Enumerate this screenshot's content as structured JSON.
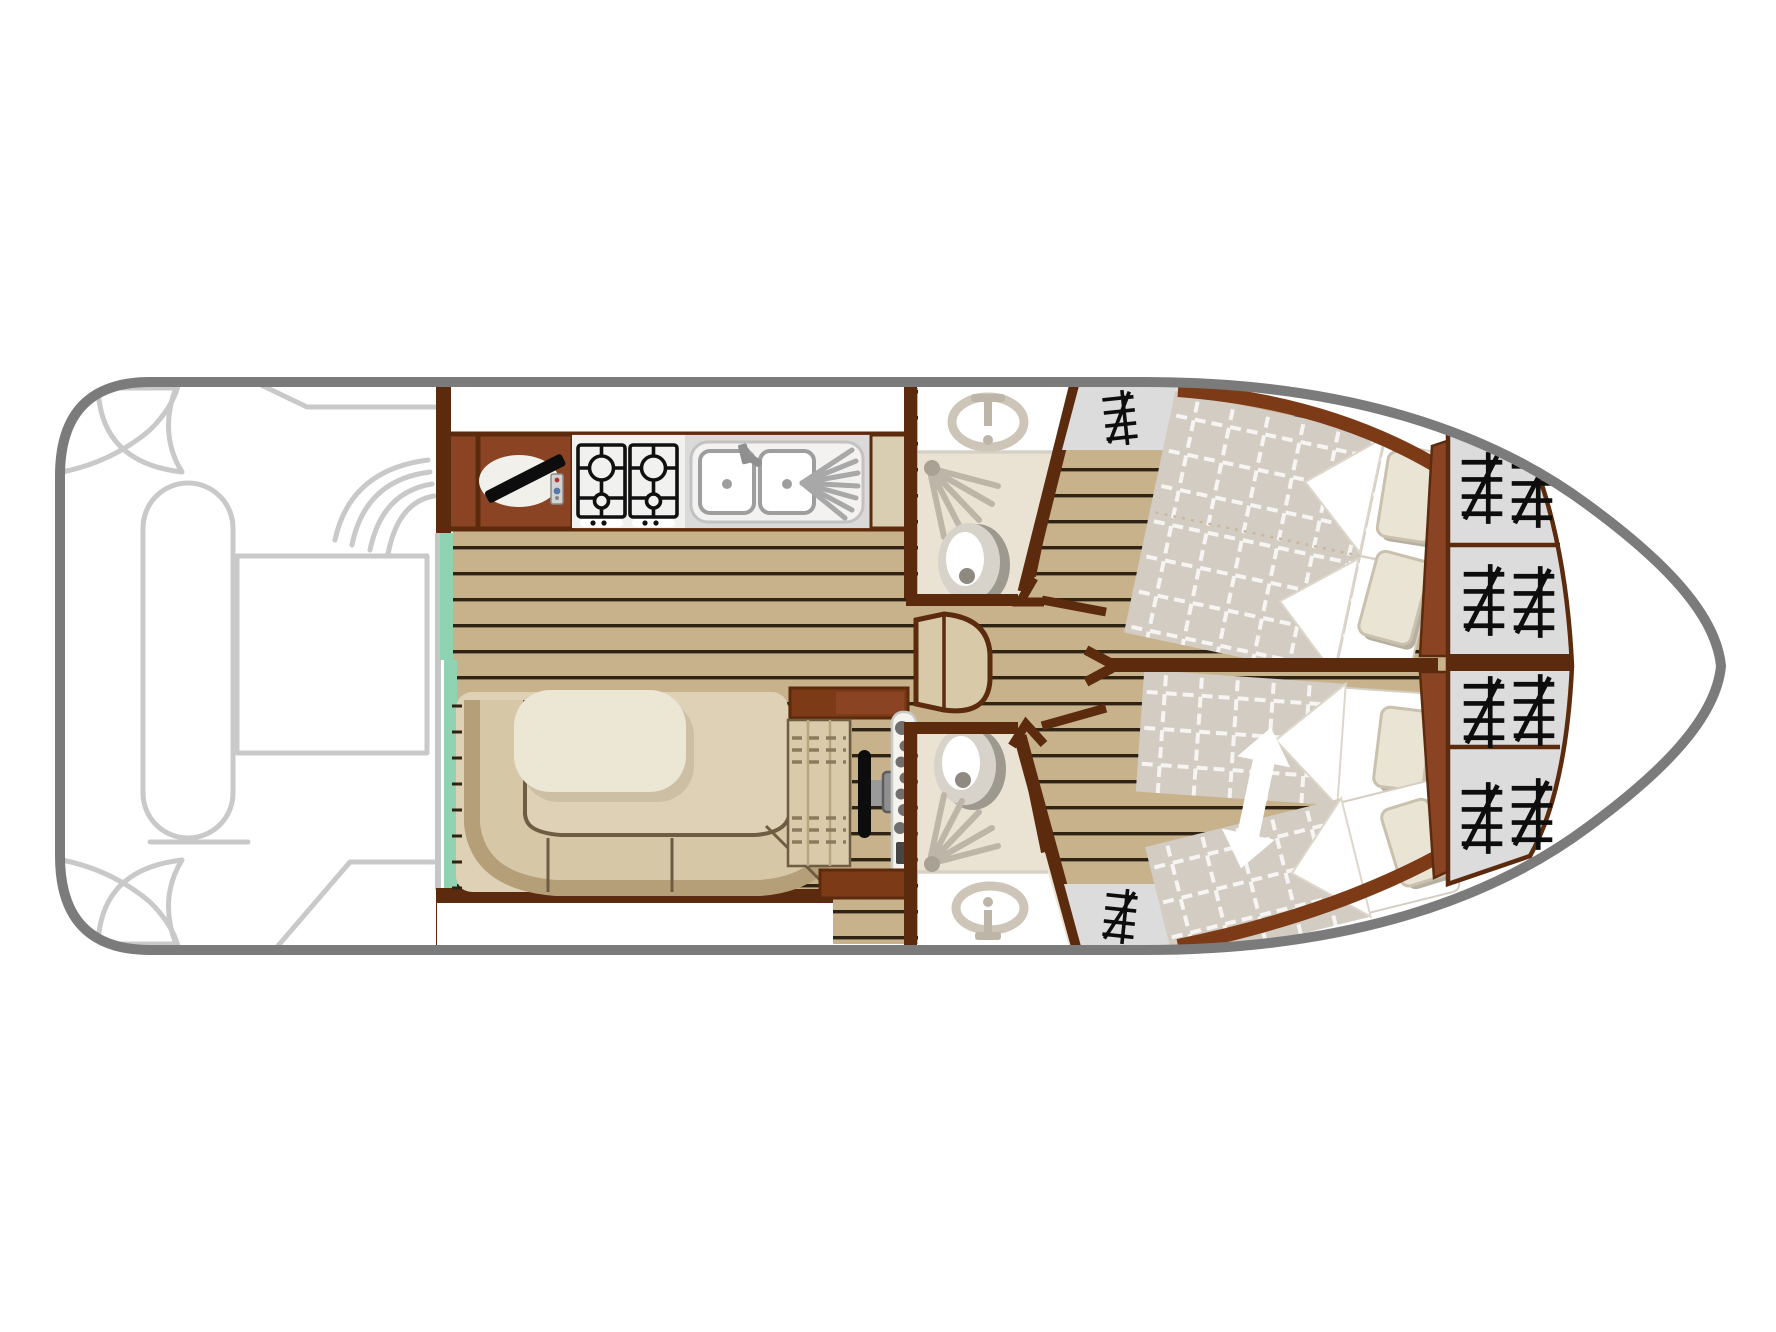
{
  "title": "Canal cruiser deck plan",
  "vessel": {
    "type": "river / canal cruising boat",
    "view": "top-down interior deck plan",
    "orientation": "bow to the right, stern (open aft deck) to the left",
    "cabins": 2,
    "bathrooms": 2,
    "berths": "1 double + 2 sliding singles"
  },
  "colors": {
    "hull": "#7b7b7b",
    "deck-line": "#c9c9c9",
    "wood": "#c8b28c",
    "wood-line": "#2f2414",
    "wall": "#5c2b0e",
    "cabinet": "#8a4424",
    "cabinet-dark": "#7c3a17",
    "glass": "#8fd3b3",
    "glass-frame": "#c6c6c6",
    "carpet": "#ded1b6",
    "sofa": "#d6c7a7",
    "sofa-back": "#b59f79",
    "sofa-line": "#6f5d43",
    "table": "#ece6d5",
    "bath": "#eae2d2",
    "bath-line": "#d6d1c5",
    "fixture": "#bdb5a7",
    "fixture-dark": "#9d998f",
    "fixture-mid": "#d7d3ca",
    "fixture-deep": "#8e8a81",
    "steel": "#8f8f8f",
    "hob-panel": "#f1f1ef",
    "hob-line": "#101010",
    "sink-panel": "#dadada",
    "worktop": "#d9ceb2",
    "seat": "#d9caa9",
    "seat-line": "#8a7a5e",
    "duvet": "#d3ccc3",
    "pillow": "#eae4d4",
    "pillow-shadow": "#b7afa0",
    "sheet": "#ffffff",
    "wardrobe": "#dcdcdc",
    "hanger": "#0d0d0d",
    "tv": "#0d0d0d",
    "arrow": "#ffffff",
    "steps": "#d8caa9",
    "white": "#ffffff"
  },
  "areas": {
    "aft_deck": {
      "name": "Aft deck cockpit",
      "features": [
        "bench seat",
        "cockpit table",
        "curved corner seats",
        "boarding steps",
        "transom cut-outs"
      ]
    },
    "galley": {
      "name": "Galley",
      "features": [
        "TV cabinet with swivel TV and remote",
        "4-burner gas hob",
        "double sink with drainer",
        "worktop"
      ]
    },
    "saloon": {
      "name": "Saloon",
      "features": [
        "teak plank floor",
        "sliding glass door to aft deck"
      ]
    },
    "dinette": {
      "name": "Dinette",
      "features": [
        "U-shaped sofa",
        "oval table"
      ]
    },
    "helm": {
      "name": "Inside helm station",
      "features": [
        "helm bench with stitched cushion",
        "steering wheel",
        "engine control console"
      ]
    },
    "companionway": {
      "name": "Companionway step unit between saloon and cabins"
    },
    "bathroom_port": {
      "name": "Port bathroom",
      "features": [
        "washbasin",
        "shower",
        "toilet",
        "hinged door"
      ]
    },
    "bathroom_starboard": {
      "name": "Starboard bathroom",
      "features": [
        "washbasin",
        "shower",
        "toilet",
        "hinged door"
      ]
    },
    "cabin_port": {
      "name": "Forward port cabin",
      "features": [
        "double bed with checked duvet",
        "2 pillows",
        "hanging wardrobe"
      ]
    },
    "cabin_starboard": {
      "name": "Forward starboard cabin",
      "features": [
        "two single beds that slide together (white arrow)",
        "2 pillows",
        "hanging wardrobe"
      ]
    },
    "bow_lockers": {
      "name": "Bow hanging lockers",
      "cells": 4
    }
  }
}
